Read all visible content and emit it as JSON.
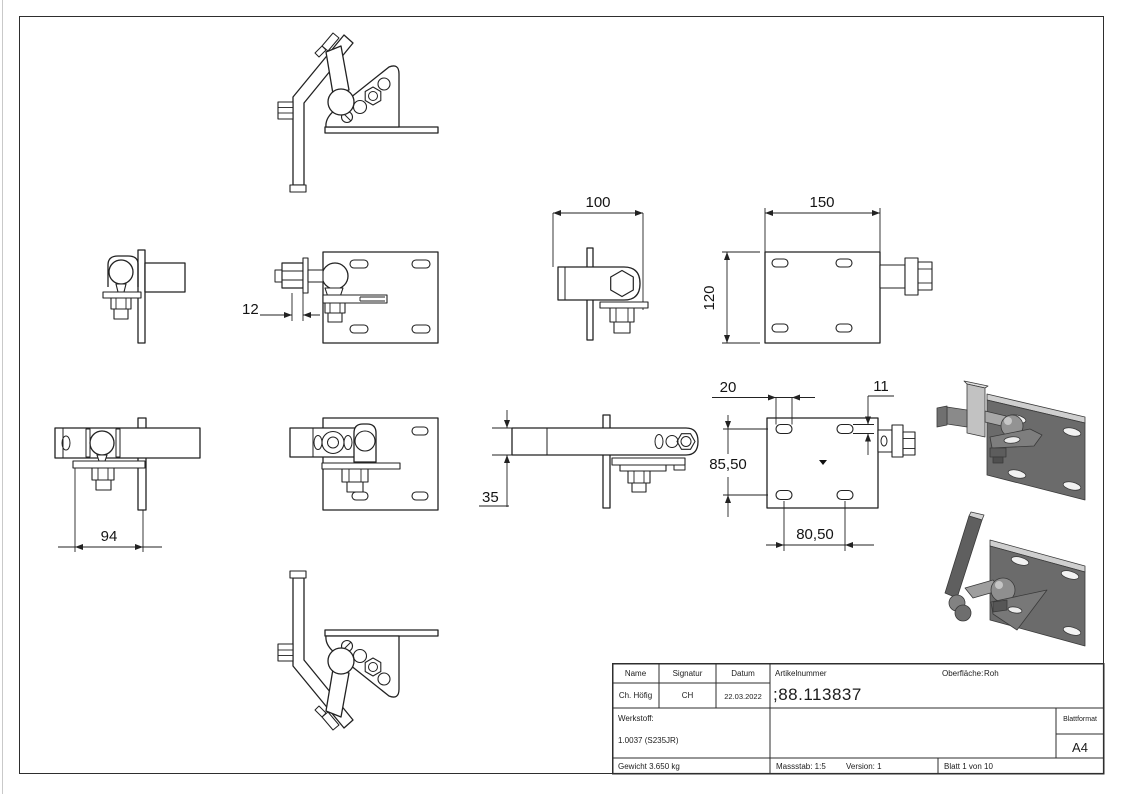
{
  "drawing": {
    "dimensions": {
      "plate_offset": "12",
      "top_view_length": "100",
      "plate_width": "150",
      "plate_height": "120",
      "side_view_length": "94",
      "arm_height": "35",
      "slot_length": "20",
      "slot_width": "11",
      "hole_spacing_vertical": "85,50",
      "hole_spacing_horizontal": "80,50"
    }
  },
  "title_block": {
    "name_label": "Name",
    "signature_label": "Signatur",
    "date_label": "Datum",
    "name": "Ch. Höfig",
    "signature": "CH",
    "date": "22.03.2022",
    "article_label": "Artikelnummer",
    "article_number": ";88.113837",
    "surface_label": "Oberfläche:",
    "surface_value": "Roh",
    "material_label": "Werkstoff:",
    "material_value": "1.0037 (S235JR)",
    "weight": "Gewicht 3.650 kg",
    "scale": "Massstab: 1:5",
    "version": "Version: 1",
    "sheet": "Blatt 1 von 10",
    "format_label": "Blattformat",
    "format_value": "A4"
  },
  "colors": {
    "line": "#222222",
    "render_gray": "#6b6b6b",
    "render_light": "#cfcfcf"
  }
}
